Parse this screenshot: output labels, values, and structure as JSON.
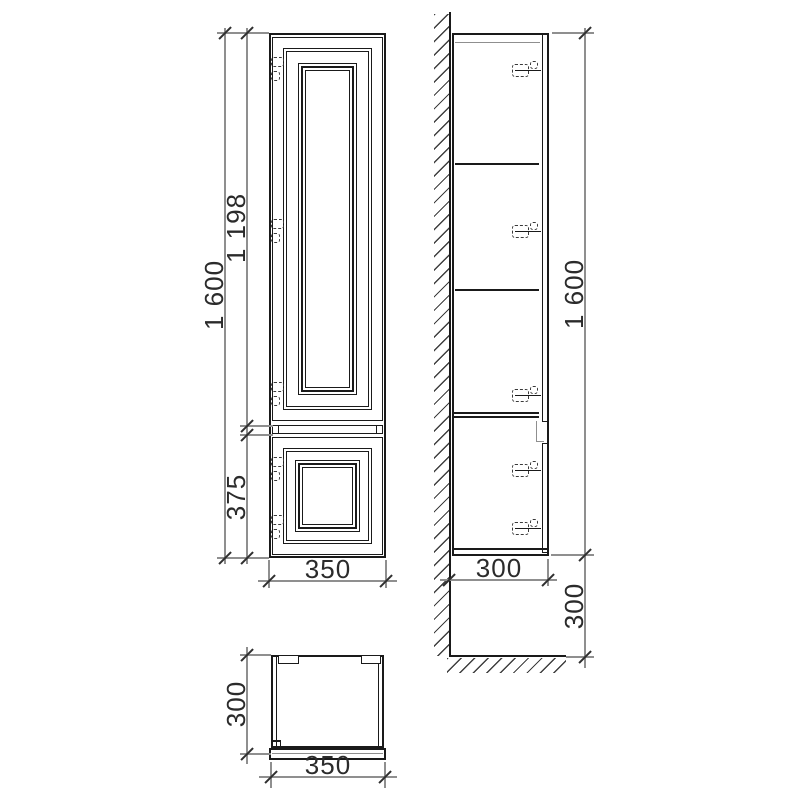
{
  "colors": {
    "object_line": "#1a1a1a",
    "dimension_line": "#8f8f8f",
    "text": "#2b2b2b",
    "background": "#ffffff"
  },
  "front_view": {
    "dim_height_total": "1 600",
    "dim_upper_door_height": "1 198",
    "dim_lower_door_height": "375",
    "dim_width": "350"
  },
  "side_view": {
    "dim_height_total": "1 600",
    "dim_depth": "300",
    "dim_floor_clearance": "300"
  },
  "top_view": {
    "dim_depth": "300",
    "dim_width": "350"
  }
}
